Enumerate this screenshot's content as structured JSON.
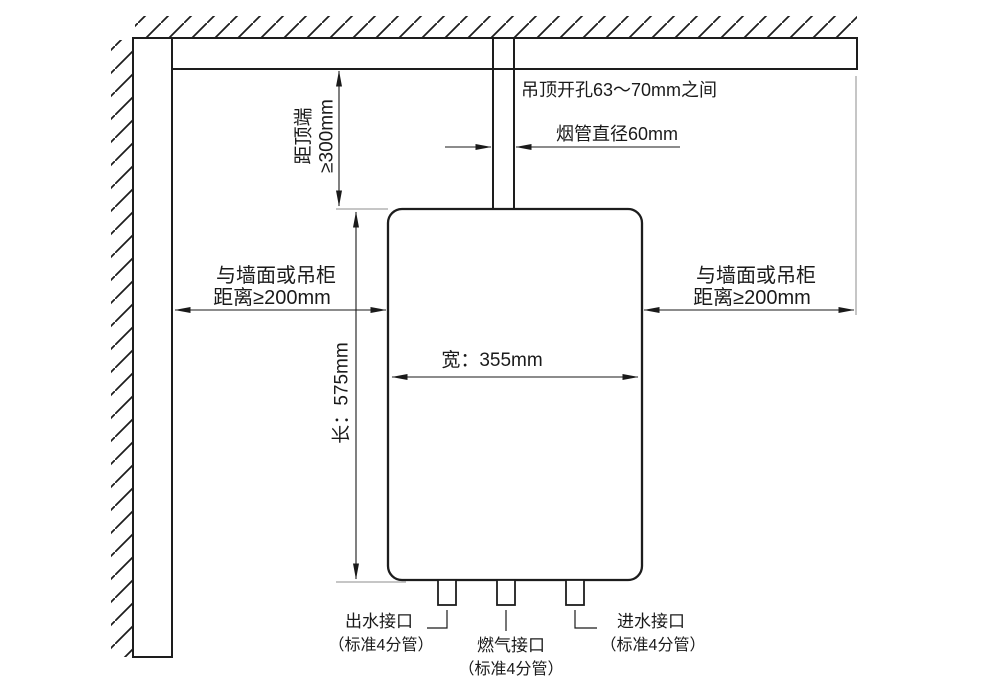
{
  "diagram": {
    "kind": "water-heater-installation-clearance-diagram",
    "ceiling_hole_label": "吊顶开孔63～70mm之间",
    "flue_diameter_label": "烟管直径60mm",
    "clearance_top": {
      "line1": "距顶端",
      "line2": "≥300mm"
    },
    "clearance_left": {
      "line1": "与墙面或吊柜",
      "line2": "距离≥200mm"
    },
    "clearance_right": {
      "line1": "与墙面或吊柜",
      "line2": "距离≥200mm"
    },
    "height_label": "长：575mm",
    "width_label": "宽：355mm",
    "connections": [
      {
        "name": "出水接口",
        "spec": "（标准4分管）"
      },
      {
        "name": "燃气接口",
        "spec": "（标准4分管）"
      },
      {
        "name": "进水接口",
        "spec": "（标准4分管）"
      }
    ],
    "colors": {
      "line": "#1d1d1d",
      "dimension_line": "#1a1a1a",
      "extension_line": "#8c8c8c",
      "background": "#ffffff"
    }
  }
}
